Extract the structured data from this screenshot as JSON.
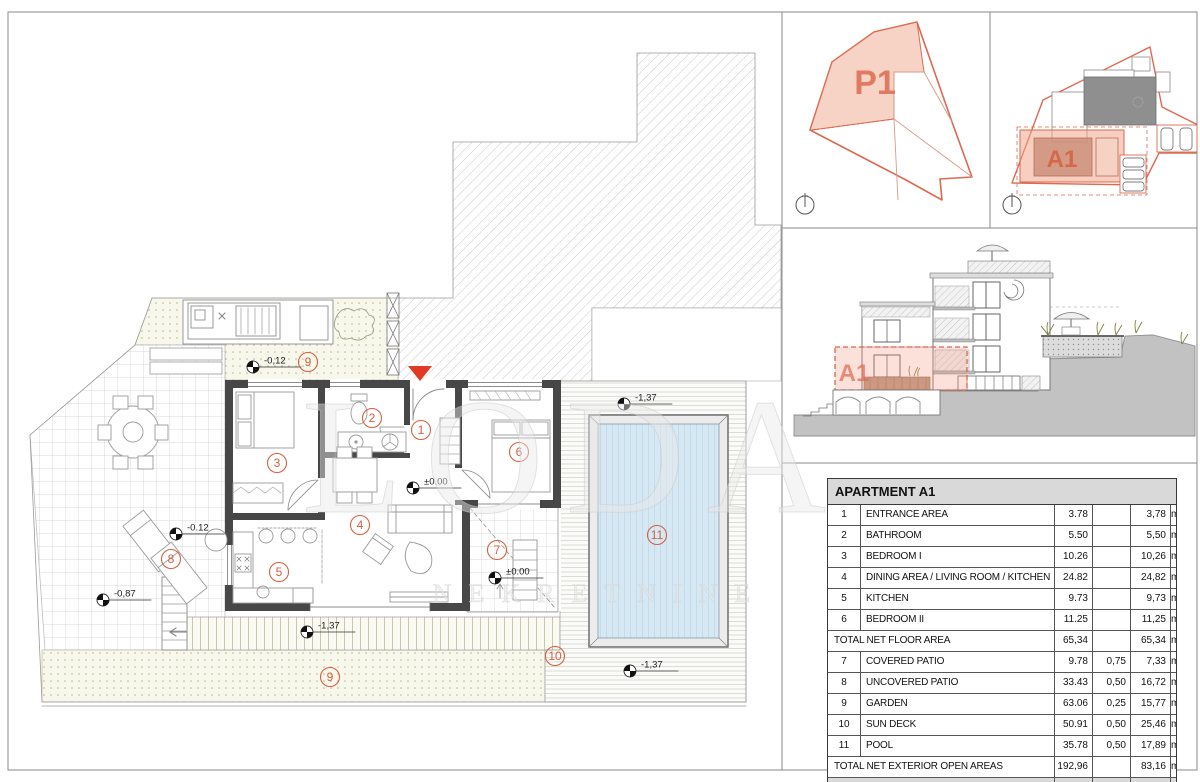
{
  "sheet": {
    "watermark_line1": "LODA",
    "watermark_line2": "NEKRETNINE"
  },
  "colors": {
    "accent": "#d4603f",
    "highlight_fill": "#f3c4b2",
    "entrance_marker": "#e03a22",
    "pool_water": "#d6e8f3",
    "wall": "#474747"
  },
  "site_plan_p1": {
    "label": "P1"
  },
  "site_plan_a1": {
    "label": "A1"
  },
  "elevation": {
    "label": "A1"
  },
  "floor_plan": {
    "room_labels": [
      {
        "no": "1",
        "x": 421,
        "y": 430
      },
      {
        "no": "2",
        "x": 372,
        "y": 418
      },
      {
        "no": "3",
        "x": 277,
        "y": 463
      },
      {
        "no": "4",
        "x": 360,
        "y": 525
      },
      {
        "no": "5",
        "x": 279,
        "y": 572
      },
      {
        "no": "6",
        "x": 519,
        "y": 452
      },
      {
        "no": "7",
        "x": 497,
        "y": 550
      },
      {
        "no": "8",
        "x": 171,
        "y": 559
      },
      {
        "no": "9",
        "x": 308,
        "y": 362
      },
      {
        "no": "9",
        "x": 330,
        "y": 677
      },
      {
        "no": "10",
        "x": 555,
        "y": 656
      },
      {
        "no": "11",
        "x": 657,
        "y": 535
      }
    ],
    "level_markers": [
      {
        "text": "-0,12",
        "cx": 253,
        "cy": 367
      },
      {
        "text": "-0.12",
        "cx": 176,
        "cy": 534
      },
      {
        "text": "-0,87",
        "cx": 103,
        "cy": 600
      },
      {
        "text": "±0.00",
        "cx": 413,
        "cy": 488
      },
      {
        "text": "±0.00",
        "cx": 495,
        "cy": 578
      },
      {
        "text": "-1,37",
        "cx": 307,
        "cy": 632
      },
      {
        "text": "-1,37",
        "cx": 624,
        "cy": 404
      },
      {
        "text": "-1,37",
        "cx": 630,
        "cy": 671
      }
    ]
  },
  "area_table": {
    "title": "APARTMENT A1",
    "unit": "m²",
    "rows": [
      {
        "no": "1",
        "label": "ENTRANCE AREA",
        "area": "3.78",
        "coef": "",
        "net": "3,78",
        "type": "normal"
      },
      {
        "no": "2",
        "label": "BATHROOM",
        "area": "5.50",
        "coef": "",
        "net": "5,50",
        "type": "normal"
      },
      {
        "no": "3",
        "label": "BEDROOM I",
        "area": "10.26",
        "coef": "",
        "net": "10,26",
        "type": "normal"
      },
      {
        "no": "4",
        "label": "DINING AREA / LIVING ROOM / KITCHEN",
        "area": "24.82",
        "coef": "",
        "net": "24,82",
        "type": "normal"
      },
      {
        "no": "5",
        "label": "KITCHEN",
        "area": "9.73",
        "coef": "",
        "net": "9,73",
        "type": "normal"
      },
      {
        "no": "6",
        "label": "BEDROOM II",
        "area": "11.25",
        "coef": "",
        "net": "11,25",
        "type": "normal"
      },
      {
        "no": "",
        "label": "TOTAL NET FLOOR AREA",
        "area": "65,34",
        "coef": "",
        "net": "65,34",
        "type": "total"
      },
      {
        "no": "7",
        "label": "COVERED PATIO",
        "area": "9.78",
        "coef": "0,75",
        "net": "7,33",
        "type": "normal"
      },
      {
        "no": "8",
        "label": "UNCOVERED PATIO",
        "area": "33.43",
        "coef": "0,50",
        "net": "16,72",
        "type": "normal"
      },
      {
        "no": "9",
        "label": "GARDEN",
        "area": "63.06",
        "coef": "0,25",
        "net": "15,77",
        "type": "normal"
      },
      {
        "no": "10",
        "label": "SUN DECK",
        "area": "50.91",
        "coef": "0,50",
        "net": "25,46",
        "type": "normal"
      },
      {
        "no": "11",
        "label": "POOL",
        "area": "35.78",
        "coef": "0,50",
        "net": "17,89",
        "type": "normal"
      },
      {
        "no": "",
        "label": "TOTAL NET EXTERIOR OPEN AREAS",
        "area": "192,96",
        "coef": "",
        "net": "83,16",
        "type": "total"
      },
      {
        "no": "",
        "label": "APARTMENT A1 TOTAL NET AREA",
        "area": "258,30",
        "coef": "",
        "net": "148,50",
        "type": "grand"
      }
    ]
  }
}
